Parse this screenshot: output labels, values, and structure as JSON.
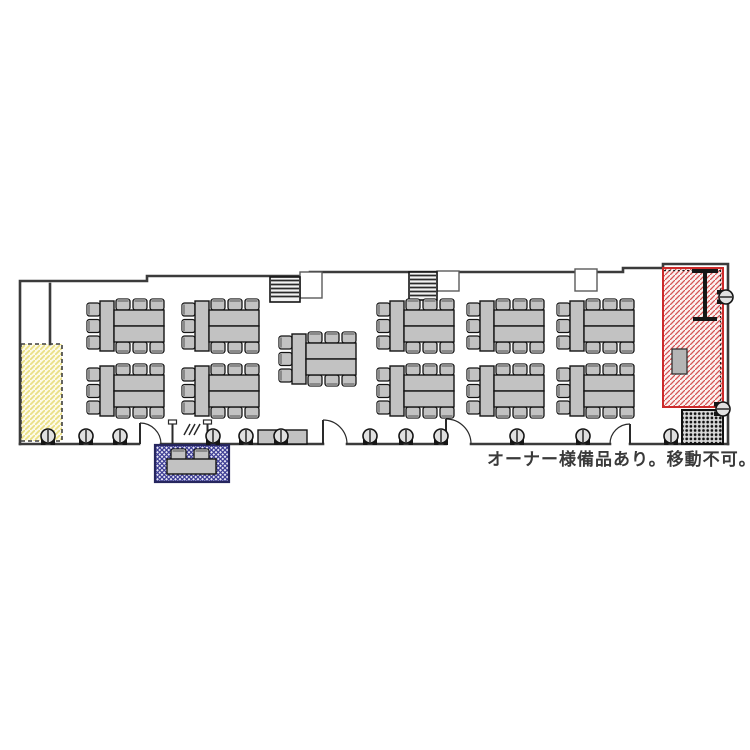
{
  "note": {
    "text": "オーナー様備品あり。移動不可。",
    "x": 487,
    "y": 465
  },
  "colors": {
    "wall": "#3b3b3b",
    "furniture_fill": "#c2c2c2",
    "furniture_stroke": "#141414",
    "chair_back": "#8a8a8a",
    "stool_fill": "#e0e0e0",
    "note_text": "#3a3a3a",
    "yellow_zone_bg": "#fdfbe8",
    "yellow_zone_line": "#eadf84",
    "yellow_zone_border": "#3f3f3f",
    "red_zone_bg": "#fbf1f0",
    "red_zone_line": "#d65252",
    "red_zone_border": "#cc2a2a",
    "blue_zone_bg": "#e9e9f6",
    "blue_zone_line": "#3d3d94",
    "blue_zone_border": "#26265e",
    "grate_bg": "#d8d8d8",
    "grate_dot": "#111111"
  },
  "walls": [
    [
      [
        20,
        444
      ],
      [
        20,
        281
      ],
      [
        147,
        281
      ],
      [
        147,
        276
      ],
      [
        310,
        276
      ],
      [
        310,
        272
      ],
      [
        623,
        272
      ],
      [
        623,
        268
      ],
      [
        663,
        268
      ],
      [
        663,
        264
      ],
      [
        728,
        264
      ],
      [
        728,
        444
      ]
    ],
    [
      [
        50,
        284
      ],
      [
        50,
        344
      ]
    ],
    [
      [
        20,
        444
      ],
      [
        139,
        444
      ]
    ],
    [
      [
        161,
        444
      ],
      [
        323,
        444
      ]
    ],
    [
      [
        347,
        444
      ],
      [
        446,
        444
      ]
    ],
    [
      [
        471,
        444
      ],
      [
        610,
        444
      ]
    ],
    [
      [
        630,
        444
      ],
      [
        728,
        444
      ]
    ]
  ],
  "louvers": [
    {
      "x": 270,
      "y": 277,
      "w": 30,
      "h": 25
    },
    {
      "x": 409,
      "y": 272,
      "w": 28,
      "h": 28
    }
  ],
  "wall_notches": [
    {
      "x": 300,
      "y": 272,
      "w": 22,
      "h": 26
    },
    {
      "x": 437,
      "y": 271,
      "w": 22,
      "h": 20
    },
    {
      "x": 575,
      "y": 269,
      "w": 22,
      "h": 22
    }
  ],
  "zones": {
    "yellow": {
      "x": 21,
      "y": 344,
      "w": 41,
      "h": 97
    },
    "red": {
      "x": 663,
      "y": 268,
      "w": 60,
      "h": 139
    },
    "blue": {
      "x": 155,
      "y": 445,
      "w": 74,
      "h": 37
    },
    "grate": {
      "x": 682,
      "y": 410,
      "w": 41,
      "h": 34
    }
  },
  "red_zone_items": {
    "ibeam": {
      "cx": 705,
      "top": 269,
      "bottom": 321,
      "flange_w": 26,
      "stem_w": 4
    },
    "box": {
      "x": 672,
      "y": 349,
      "w": 15,
      "h": 25
    }
  },
  "blue_zone_items": {
    "table": {
      "x": 167,
      "y": 459,
      "w": 49,
      "h": 15
    },
    "chairs": [
      {
        "x": 171,
        "y": 449
      },
      {
        "x": 194,
        "y": 449
      }
    ]
  },
  "table_units": [
    {
      "x": 86,
      "y": 298
    },
    {
      "x": 86,
      "y": 363
    },
    {
      "x": 181,
      "y": 298
    },
    {
      "x": 181,
      "y": 363
    },
    {
      "x": 278,
      "y": 331
    },
    {
      "x": 376,
      "y": 298
    },
    {
      "x": 376,
      "y": 363
    },
    {
      "x": 466,
      "y": 298
    },
    {
      "x": 466,
      "y": 363
    },
    {
      "x": 556,
      "y": 298
    },
    {
      "x": 556,
      "y": 363
    }
  ],
  "stools_bottom": {
    "cy": 436,
    "cx": [
      48,
      86,
      120,
      213,
      246,
      281,
      370,
      406,
      441,
      517,
      583,
      671
    ]
  },
  "stools_right": [
    {
      "cx": 726,
      "cy": 297
    },
    {
      "cx": 723,
      "cy": 409
    }
  ],
  "benches": [
    {
      "x": 258,
      "y": 430,
      "w": 49,
      "h": 14
    }
  ],
  "doors": [
    {
      "hinge": 140,
      "width": 21,
      "dir": 1
    },
    {
      "hinge": 323,
      "width": 24,
      "dir": 1
    },
    {
      "hinge": 446,
      "width": 25,
      "dir": 1
    },
    {
      "hinge": 630,
      "width": 20,
      "dir": -1
    }
  ],
  "posts": {
    "xs": [
      172.5,
      207.5
    ],
    "top": 420,
    "bottom": 445,
    "slashes": [
      [
        184,
        435,
        190,
        424
      ],
      [
        189,
        435,
        195,
        424
      ],
      [
        194,
        435,
        200,
        424
      ]
    ]
  }
}
